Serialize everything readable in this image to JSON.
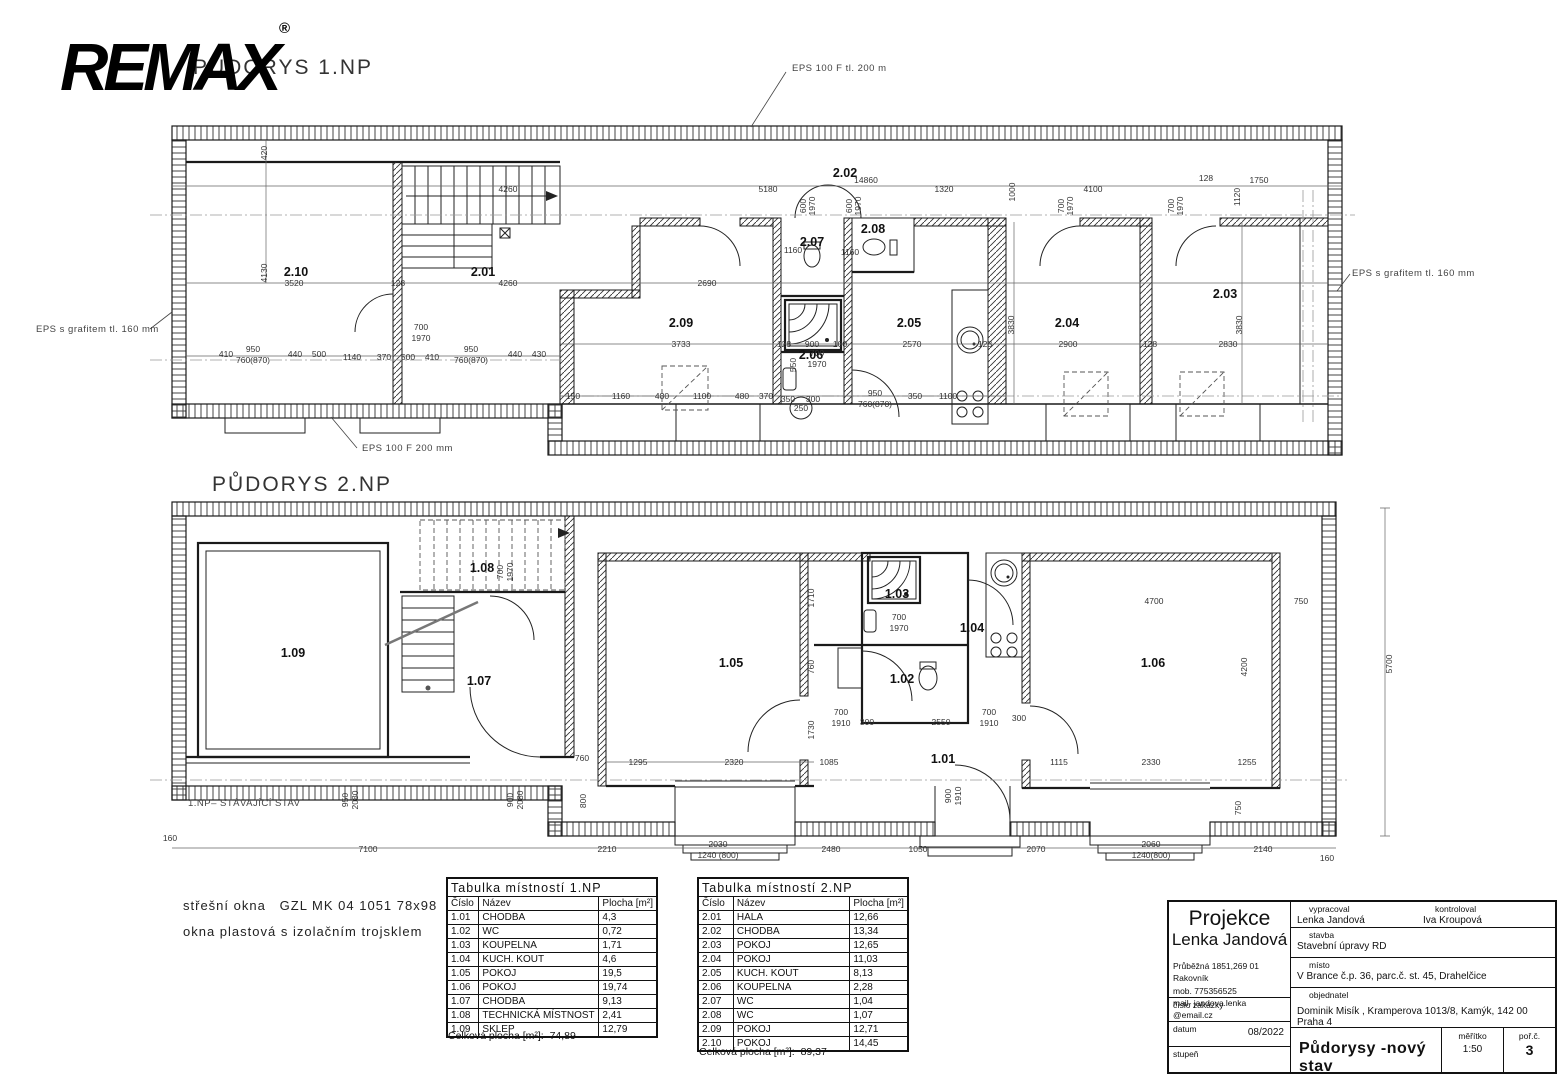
{
  "logo": {
    "brand": "REMAX",
    "registered": "®"
  },
  "plan1": {
    "title": "PŮDORYS 1.NP",
    "labels": [
      {
        "t": "2.10",
        "x": 296,
        "y": 276,
        "c": "room",
        "n": "room-label-2-10"
      },
      {
        "t": "2.01",
        "x": 483,
        "y": 276,
        "c": "room",
        "n": "room-label-2-01"
      },
      {
        "t": "2.02",
        "x": 845,
        "y": 177,
        "c": "room",
        "n": "room-label-2-02"
      },
      {
        "t": "2.09",
        "x": 681,
        "y": 327,
        "c": "room",
        "n": "room-label-2-09"
      },
      {
        "t": "2.07",
        "x": 812,
        "y": 246,
        "c": "room",
        "n": "room-label-2-07"
      },
      {
        "t": "2.08",
        "x": 873,
        "y": 233,
        "c": "room",
        "n": "room-label-2-08"
      },
      {
        "t": "2.05",
        "x": 909,
        "y": 327,
        "c": "room",
        "n": "room-label-2-05"
      },
      {
        "t": "2.06",
        "x": 811,
        "y": 359,
        "c": "room",
        "n": "room-label-2-06"
      },
      {
        "t": "2.04",
        "x": 1067,
        "y": 327,
        "c": "room",
        "n": "room-label-2-04"
      },
      {
        "t": "2.03",
        "x": 1225,
        "y": 298,
        "c": "room",
        "n": "room-label-2-03"
      },
      {
        "t": "EPS 100 F tl. 200 m",
        "x": 792,
        "y": 71,
        "c": "note",
        "n": "callout-eps-top"
      },
      {
        "t": "EPS s grafitem tl. 160 mm",
        "x": 36,
        "y": 332,
        "c": "note",
        "n": "callout-eps-left"
      },
      {
        "t": "EPS s grafitem tl. 160 mm",
        "x": 1352,
        "y": 276,
        "c": "note",
        "n": "callout-eps-right"
      },
      {
        "t": "EPS 100 F 200 mm",
        "x": 362,
        "y": 451,
        "c": "note",
        "n": "callout-eps-bottom"
      },
      {
        "t": "14860",
        "x": 866,
        "y": 183
      },
      {
        "t": "5180",
        "x": 768,
        "y": 192
      },
      {
        "t": "1320",
        "x": 944,
        "y": 192
      },
      {
        "t": "4100",
        "x": 1093,
        "y": 192
      },
      {
        "t": "1750",
        "x": 1259,
        "y": 183
      },
      {
        "t": "128",
        "x": 1206,
        "y": 181
      },
      {
        "t": "1120",
        "x": 1240,
        "y": 197,
        "r": -90
      },
      {
        "t": "1000",
        "x": 1015,
        "y": 192,
        "r": -90
      },
      {
        "t": "600",
        "x": 806,
        "y": 206,
        "r": -90
      },
      {
        "t": "1970",
        "x": 815,
        "y": 206,
        "r": -90
      },
      {
        "t": "600",
        "x": 852,
        "y": 206,
        "r": -90
      },
      {
        "t": "1970",
        "x": 861,
        "y": 206,
        "r": -90
      },
      {
        "t": "700",
        "x": 1064,
        "y": 206,
        "r": -90
      },
      {
        "t": "1970",
        "x": 1073,
        "y": 206,
        "r": -90
      },
      {
        "t": "700",
        "x": 1174,
        "y": 206,
        "r": -90
      },
      {
        "t": "1970",
        "x": 1183,
        "y": 206,
        "r": -90
      },
      {
        "t": "420",
        "x": 267,
        "y": 153,
        "r": -90
      },
      {
        "t": "4130",
        "x": 267,
        "y": 273,
        "r": -90
      },
      {
        "t": "4260",
        "x": 508,
        "y": 192
      },
      {
        "t": "3520",
        "x": 294,
        "y": 286
      },
      {
        "t": "128",
        "x": 398,
        "y": 286
      },
      {
        "t": "4260",
        "x": 508,
        "y": 286
      },
      {
        "t": "2690",
        "x": 707,
        "y": 286
      },
      {
        "t": "700",
        "x": 421,
        "y": 330
      },
      {
        "t": "1970",
        "x": 421,
        "y": 341
      },
      {
        "t": "1140",
        "x": 352,
        "y": 360
      },
      {
        "t": "410",
        "x": 226,
        "y": 357
      },
      {
        "t": "950",
        "x": 253,
        "y": 352
      },
      {
        "t": "760(870)",
        "x": 253,
        "y": 363
      },
      {
        "t": "440",
        "x": 295,
        "y": 357
      },
      {
        "t": "500",
        "x": 319,
        "y": 357
      },
      {
        "t": "370",
        "x": 384,
        "y": 360
      },
      {
        "t": "500",
        "x": 408,
        "y": 360
      },
      {
        "t": "410",
        "x": 432,
        "y": 360
      },
      {
        "t": "950",
        "x": 471,
        "y": 352
      },
      {
        "t": "760(870)",
        "x": 471,
        "y": 363
      },
      {
        "t": "440",
        "x": 515,
        "y": 357
      },
      {
        "t": "430",
        "x": 539,
        "y": 357
      },
      {
        "t": "3733",
        "x": 681,
        "y": 347
      },
      {
        "t": "128",
        "x": 784,
        "y": 347
      },
      {
        "t": "900",
        "x": 812,
        "y": 347
      },
      {
        "t": "100",
        "x": 840,
        "y": 347
      },
      {
        "t": "2570",
        "x": 912,
        "y": 347
      },
      {
        "t": "128",
        "x": 985,
        "y": 347
      },
      {
        "t": "2900",
        "x": 1068,
        "y": 347
      },
      {
        "t": "128",
        "x": 1150,
        "y": 347
      },
      {
        "t": "2830",
        "x": 1228,
        "y": 347
      },
      {
        "t": "3830",
        "x": 1014,
        "y": 325,
        "r": -90
      },
      {
        "t": "3830",
        "x": 1242,
        "y": 325,
        "r": -90
      },
      {
        "t": "550",
        "x": 796,
        "y": 365,
        "r": -90
      },
      {
        "t": "700",
        "x": 817,
        "y": 356
      },
      {
        "t": "1970",
        "x": 817,
        "y": 367
      },
      {
        "t": "250",
        "x": 801,
        "y": 411
      },
      {
        "t": "1160",
        "x": 793,
        "y": 253
      },
      {
        "t": "1160",
        "x": 850,
        "y": 255
      },
      {
        "t": "150",
        "x": 573,
        "y": 399
      },
      {
        "t": "1160",
        "x": 621,
        "y": 399
      },
      {
        "t": "480",
        "x": 662,
        "y": 399
      },
      {
        "t": "1100",
        "x": 702,
        "y": 399
      },
      {
        "t": "480",
        "x": 742,
        "y": 399
      },
      {
        "t": "370",
        "x": 766,
        "y": 399
      },
      {
        "t": "350",
        "x": 788,
        "y": 402
      },
      {
        "t": "300",
        "x": 813,
        "y": 402
      },
      {
        "t": "950",
        "x": 875,
        "y": 396
      },
      {
        "t": "760(870)",
        "x": 875,
        "y": 407
      },
      {
        "t": "350",
        "x": 915,
        "y": 399
      },
      {
        "t": "1100",
        "x": 948,
        "y": 399
      }
    ]
  },
  "plan2": {
    "title": "PŮDORYS 2.NP",
    "labels": [
      {
        "t": "1.09",
        "x": 293,
        "y": 657,
        "c": "room",
        "n": "room-label-1-09"
      },
      {
        "t": "1.08",
        "x": 482,
        "y": 572,
        "c": "room",
        "n": "room-label-1-08"
      },
      {
        "t": "1.07",
        "x": 479,
        "y": 685,
        "c": "room",
        "n": "room-label-1-07"
      },
      {
        "t": "1.05",
        "x": 731,
        "y": 667,
        "c": "room",
        "n": "room-label-1-05"
      },
      {
        "t": "1.03",
        "x": 897,
        "y": 598,
        "c": "room",
        "n": "room-label-1-03"
      },
      {
        "t": "1.02",
        "x": 902,
        "y": 683,
        "c": "room",
        "n": "room-label-1-02"
      },
      {
        "t": "1.04",
        "x": 972,
        "y": 632,
        "c": "room",
        "n": "room-label-1-04"
      },
      {
        "t": "1.01",
        "x": 943,
        "y": 763,
        "c": "room",
        "n": "room-label-1-01"
      },
      {
        "t": "1.06",
        "x": 1153,
        "y": 667,
        "c": "room",
        "n": "room-label-1-06"
      },
      {
        "t": "1.NP– STÁVAJÍCÍ STAV",
        "x": 188,
        "y": 806,
        "c": "note",
        "n": "existing-state-label"
      },
      {
        "t": "700",
        "x": 503,
        "y": 572,
        "r": -90
      },
      {
        "t": "1970",
        "x": 513,
        "y": 572,
        "r": -90
      },
      {
        "t": "760",
        "x": 582,
        "y": 761
      },
      {
        "t": "800",
        "x": 586,
        "y": 801,
        "r": -90
      },
      {
        "t": "950",
        "x": 348,
        "y": 800,
        "r": -90
      },
      {
        "t": "2080",
        "x": 358,
        "y": 800,
        "r": -90
      },
      {
        "t": "900",
        "x": 513,
        "y": 800,
        "r": -90
      },
      {
        "t": "2080",
        "x": 523,
        "y": 800,
        "r": -90
      },
      {
        "t": "160",
        "x": 170,
        "y": 841
      },
      {
        "t": "7100",
        "x": 368,
        "y": 852
      },
      {
        "t": "2210",
        "x": 607,
        "y": 852
      },
      {
        "t": "2030",
        "x": 718,
        "y": 847
      },
      {
        "t": "1240 (800)",
        "x": 718,
        "y": 858
      },
      {
        "t": "2480",
        "x": 831,
        "y": 852
      },
      {
        "t": "1050",
        "x": 918,
        "y": 852
      },
      {
        "t": "2070",
        "x": 1036,
        "y": 852
      },
      {
        "t": "2060",
        "x": 1151,
        "y": 847
      },
      {
        "t": "1240(800)",
        "x": 1151,
        "y": 858
      },
      {
        "t": "2140",
        "x": 1263,
        "y": 852
      },
      {
        "t": "160",
        "x": 1327,
        "y": 861
      },
      {
        "t": "1710",
        "x": 814,
        "y": 598,
        "r": -90
      },
      {
        "t": "760",
        "x": 814,
        "y": 667,
        "r": -90
      },
      {
        "t": "1730",
        "x": 814,
        "y": 730,
        "r": -90
      },
      {
        "t": "1295",
        "x": 638,
        "y": 765
      },
      {
        "t": "2320",
        "x": 734,
        "y": 765
      },
      {
        "t": "1085",
        "x": 829,
        "y": 765
      },
      {
        "t": "700",
        "x": 841,
        "y": 715
      },
      {
        "t": "1910",
        "x": 841,
        "y": 726
      },
      {
        "t": "300",
        "x": 867,
        "y": 725
      },
      {
        "t": "2550",
        "x": 941,
        "y": 725
      },
      {
        "t": "700",
        "x": 989,
        "y": 715
      },
      {
        "t": "1910",
        "x": 989,
        "y": 726
      },
      {
        "t": "300",
        "x": 1019,
        "y": 721
      },
      {
        "t": "900",
        "x": 951,
        "y": 796,
        "r": -90
      },
      {
        "t": "1910",
        "x": 961,
        "y": 796,
        "r": -90
      },
      {
        "t": "700",
        "x": 899,
        "y": 620
      },
      {
        "t": "1970",
        "x": 899,
        "y": 631
      },
      {
        "t": "4700",
        "x": 1154,
        "y": 604
      },
      {
        "t": "750",
        "x": 1301,
        "y": 604
      },
      {
        "t": "4200",
        "x": 1247,
        "y": 667,
        "r": -90
      },
      {
        "t": "1115",
        "x": 1059,
        "y": 765
      },
      {
        "t": "2330",
        "x": 1151,
        "y": 765
      },
      {
        "t": "1255",
        "x": 1247,
        "y": 765
      },
      {
        "t": "750",
        "x": 1241,
        "y": 808,
        "r": -90
      },
      {
        "t": "5700",
        "x": 1392,
        "y": 664,
        "r": -90
      }
    ]
  },
  "notes": {
    "line1": "střešní okna   GZL MK 04 1051 78x98",
    "line2": "okna plastová s izolačním trojsklem"
  },
  "tables": {
    "t1": {
      "title": "Tabulka místností 1.NP",
      "headers": [
        "Číslo",
        "Název",
        "Plocha [m²]"
      ],
      "rows": [
        [
          "1.01",
          "CHODBA",
          "4,3"
        ],
        [
          "1.02",
          "WC",
          "0,72"
        ],
        [
          "1.03",
          "KOUPELNA",
          "1,71"
        ],
        [
          "1.04",
          "KUCH. KOUT",
          "4,6"
        ],
        [
          "1.05",
          "POKOJ",
          "19,5"
        ],
        [
          "1.06",
          "POKOJ",
          "19,74"
        ],
        [
          "1.07",
          "CHODBA",
          "9,13"
        ],
        [
          "1.08",
          "TECHNICKÁ MÍSTNOST",
          "2,41"
        ],
        [
          "1.09",
          "SKLEP",
          "12,79"
        ]
      ],
      "total_label": "Celková plocha [m²]:",
      "total_value": "74,89"
    },
    "t2": {
      "title": "Tabulka místností 2.NP",
      "headers": [
        "Číslo",
        "Název",
        "Plocha [m²]"
      ],
      "rows": [
        [
          "2.01",
          "HALA",
          "12,66"
        ],
        [
          "2.02",
          "CHODBA",
          "13,34"
        ],
        [
          "2.03",
          "POKOJ",
          "12,65"
        ],
        [
          "2.04",
          "POKOJ",
          "11,03"
        ],
        [
          "2.05",
          "KUCH. KOUT",
          "8,13"
        ],
        [
          "2.06",
          "KOUPELNA",
          "2,28"
        ],
        [
          "2.07",
          "WC",
          "1,04"
        ],
        [
          "2.08",
          "WC",
          "1,07"
        ],
        [
          "2.09",
          "POKOJ",
          "12,71"
        ],
        [
          "2.10",
          "POKOJ",
          "14,45"
        ]
      ],
      "total_label": "Celková plocha [m²]:",
      "total_value": "89,37"
    }
  },
  "titleblock": {
    "company_line1": "Projekce",
    "company_line2": "Lenka Jandová",
    "address": "Průběžná 1851,269 01 Rakovník",
    "phone": "mob. 775356525",
    "email": "mail-  jandova.lenka @email.cz",
    "order_label": "číslo zakázky",
    "date_label": "datum",
    "date_value": "08/2022",
    "grade_label": "stupeň",
    "prepared_label": "vypracoval",
    "prepared_by": "Lenka Jandová",
    "checked_label": "kontroloval",
    "checked_by": "Iva Kroupová",
    "building_label": "stavba",
    "building": "Stavební úpravy RD",
    "place_label": "místo",
    "place": "V Brance č.p. 36, parc.č. st. 45,  Drahelčice",
    "client_label": "objednatel",
    "client": "Dominik Misík , Kramperova 1013/8, Kamýk, 142 00 Praha 4",
    "drawing_title": "Půdorysy -nový stav",
    "scale_label": "měřítko",
    "scale_value": "1:50",
    "sheet_label": "poř.č.",
    "sheet_value": "3"
  }
}
